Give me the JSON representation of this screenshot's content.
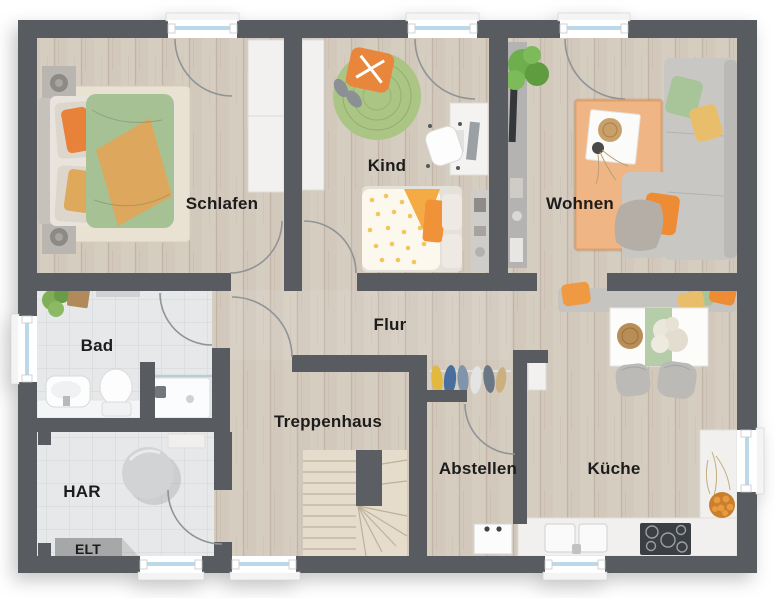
{
  "plan": {
    "type": "floor-plan",
    "language": "de",
    "rooms": [
      {
        "id": "schlafen",
        "label": "Schlafen"
      },
      {
        "id": "kind",
        "label": "Kind"
      },
      {
        "id": "wohnen",
        "label": "Wohnen"
      },
      {
        "id": "bad",
        "label": "Bad"
      },
      {
        "id": "flur",
        "label": "Flur"
      },
      {
        "id": "treppenhaus",
        "label": "Treppenhaus"
      },
      {
        "id": "abstellen",
        "label": "Abstellen"
      },
      {
        "id": "kueche",
        "label": "Küche"
      },
      {
        "id": "har",
        "label": "HAR"
      },
      {
        "id": "elt",
        "label": "ELT"
      }
    ],
    "colors": {
      "wall": "#585c60",
      "wood_floor": "#d9cfc2",
      "stair_wood": "#e6dccc",
      "tile_floor": "#e7e8e9",
      "window_glass": "#bcd9e9",
      "accent_orange": "#ee8c35",
      "accent_green": "#a8c499",
      "accent_yellow": "#e9be6a",
      "rug_orange": "#f0b584",
      "rug_green": "#abc585",
      "label_text": "#1c1c1c"
    }
  }
}
